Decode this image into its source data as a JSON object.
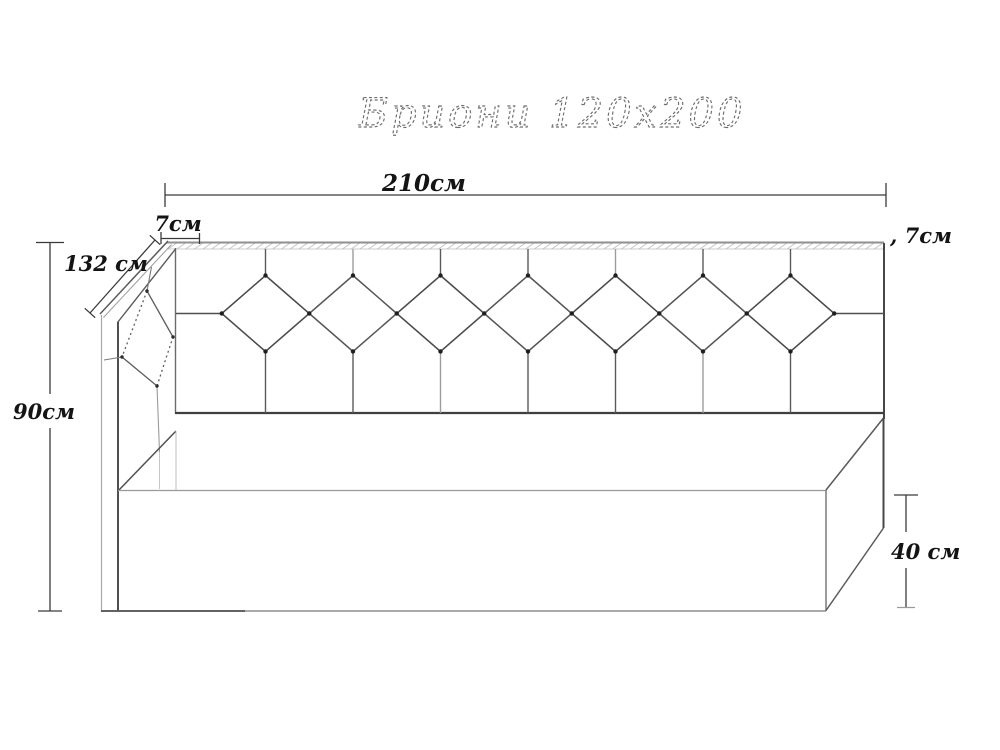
{
  "title": "Бриони 120x200",
  "dimensions": {
    "top_width": "210см",
    "panel_thickness_left": "7см",
    "panel_thickness_right": ", 7см",
    "side_panel_length": "132 см",
    "overall_height": "90см",
    "base_height": "40 см"
  },
  "figure": {
    "headboard_diamond_count": 7,
    "side_panel_diamond_count": 1
  },
  "colors": {
    "line_dark": "#474747",
    "line_mid": "#6b6b6b",
    "line_light": "#a9a9a9",
    "hatch": "#b9b9b9",
    "label_text": "#141414",
    "title_stroke": "#6e6e6e"
  }
}
